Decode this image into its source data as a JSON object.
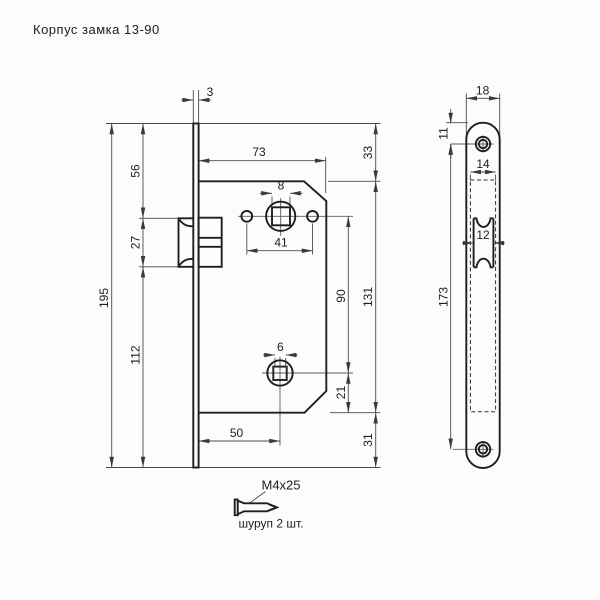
{
  "title": "Корпус замка 13-90",
  "dims_main": {
    "plate_thickness": "3",
    "body_width": "73",
    "top_margin": "33",
    "to_latch_top": "56",
    "handle_square": "8",
    "latch_height": "27",
    "holes_span": "41",
    "squares_span": "90",
    "body_height": "131",
    "plate_length": "195",
    "lower_section": "112",
    "wc_square": "6",
    "wc_to_bottom": "21",
    "wc_backset": "50",
    "bottom_margin": "31"
  },
  "dims_face": {
    "plate_width": "18",
    "screw_offset": "11",
    "body_width": "14",
    "latch_width": "12",
    "screws_span": "173"
  },
  "screw": {
    "size": "M4x25",
    "note": "шуруп 2 шт."
  },
  "colors": {
    "outline": "#1e1e1e",
    "dim_line": "#4a4a4a",
    "background": "#fcfcfc"
  }
}
